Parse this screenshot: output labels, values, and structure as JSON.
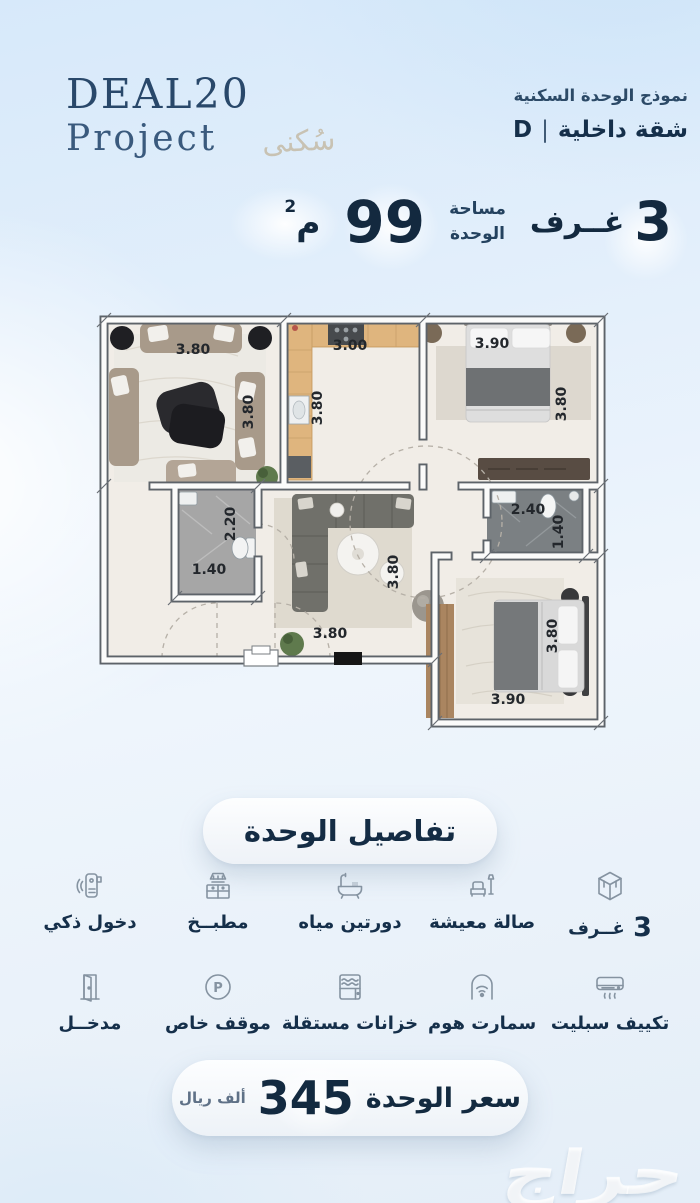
{
  "brand": {
    "name": "DEAL20",
    "sub": "Project",
    "script": "سُكنى"
  },
  "header": {
    "subtitle": "نموذج الوحدة السكنية",
    "unit_type": "شقة داخلية",
    "separator": "|",
    "unit_code": "D"
  },
  "stats": {
    "rooms_number": "3",
    "rooms_label": "غــرف",
    "area_label_line1": "مساحة",
    "area_label_line2": "الوحدة",
    "area_value": "99",
    "area_unit": "م",
    "area_unit_sup": "2"
  },
  "floorplan": {
    "dims": [
      {
        "id": "living-top",
        "value": "3.80"
      },
      {
        "id": "living-right",
        "value": "3.80"
      },
      {
        "id": "kitchen-top",
        "value": "3.00"
      },
      {
        "id": "kitchen-left",
        "value": "3.80"
      },
      {
        "id": "bedroom1-top",
        "value": "3.90"
      },
      {
        "id": "bedroom1-right",
        "value": "3.80"
      },
      {
        "id": "bath1-height",
        "value": "2.20"
      },
      {
        "id": "bath1-width",
        "value": "1.40"
      },
      {
        "id": "bath2-width",
        "value": "2.40"
      },
      {
        "id": "bath2-height",
        "value": "1.40"
      },
      {
        "id": "hall-height",
        "value": "3.80"
      },
      {
        "id": "hall-width",
        "value": "3.80"
      },
      {
        "id": "bedroom2-height",
        "value": "3.80"
      },
      {
        "id": "bedroom2-width",
        "value": "3.90"
      }
    ]
  },
  "details": {
    "title": "تفاصيل الوحدة",
    "row1": [
      {
        "icon": "rooms-cube-icon",
        "number": "3",
        "label": "غــرف"
      },
      {
        "icon": "sofa-icon",
        "label": "صالة معيشة"
      },
      {
        "icon": "bathtub-icon",
        "label": "دورتين مياه"
      },
      {
        "icon": "kitchen-icon",
        "label": "مطبــخ"
      },
      {
        "icon": "smart-lock-icon",
        "label": "دخول ذكي"
      }
    ],
    "row2": [
      {
        "icon": "ac-icon",
        "label": "تكييف سبليت"
      },
      {
        "icon": "smart-home-icon",
        "label": "سمارت هوم"
      },
      {
        "icon": "tanks-icon",
        "label": "خزانات مستقلة"
      },
      {
        "icon": "parking-icon",
        "letter": "P",
        "label": "موقف خاص"
      },
      {
        "icon": "door-icon",
        "label": "مدخــل"
      }
    ]
  },
  "price": {
    "label": "سعر الوحدة",
    "value": "345",
    "unit": "ألف ريال"
  },
  "watermark": "حراج"
}
